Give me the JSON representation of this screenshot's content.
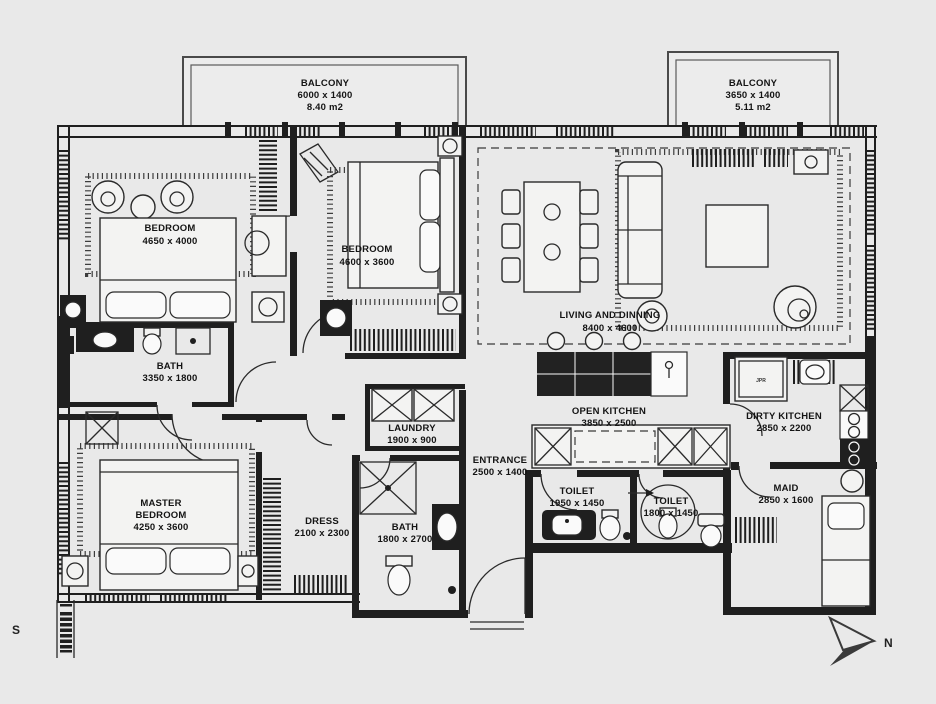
{
  "colors": {
    "background": "#e9e9e9",
    "line": "#1f1f1f"
  },
  "compass": {
    "north": "N",
    "south": "S"
  },
  "appliances": {
    "dirty_kitchen_unit": "JPR"
  },
  "labels": {
    "balcony_left": {
      "name": "BALCONY",
      "dims": "6000 x 1400",
      "area": "8.40 m2"
    },
    "balcony_right": {
      "name": "BALCONY",
      "dims": "3650 x 1400",
      "area": "5.11 m2"
    },
    "bedroom1": {
      "name": "BEDROOM",
      "dims": "4650 x 4000"
    },
    "bedroom2": {
      "name": "BEDROOM",
      "dims": "4600 x 3600"
    },
    "living": {
      "name": "LIVING AND DINNING",
      "dims": "8400 x 4600"
    },
    "bath1": {
      "name": "BATH",
      "dims": "3350 x 1800"
    },
    "laundry": {
      "name": "LAUNDRY",
      "dims": "1900 x 900"
    },
    "entrance": {
      "name": "ENTRANCE",
      "dims": "2500 x 1400"
    },
    "open_kitchen": {
      "name": "OPEN KITCHEN",
      "dims": "3850 x 2500"
    },
    "dirty_kitchen": {
      "name": "DIRTY KITCHEN",
      "dims": "2850 x 2200"
    },
    "master_bedroom": {
      "line1": "MASTER",
      "line2": "BEDROOM",
      "dims": "4250 x 3600"
    },
    "dress": {
      "name": "DRESS",
      "dims": "2100 x 2300"
    },
    "bath2": {
      "name": "BATH",
      "dims": "1800 x 2700"
    },
    "toilet1": {
      "name": "TOILET",
      "dims": "1950 x 1450"
    },
    "toilet2": {
      "name": "TOILET",
      "dims": "1800 x 1450"
    },
    "maid": {
      "name": "MAID",
      "dims": "2850 x 1600"
    }
  }
}
